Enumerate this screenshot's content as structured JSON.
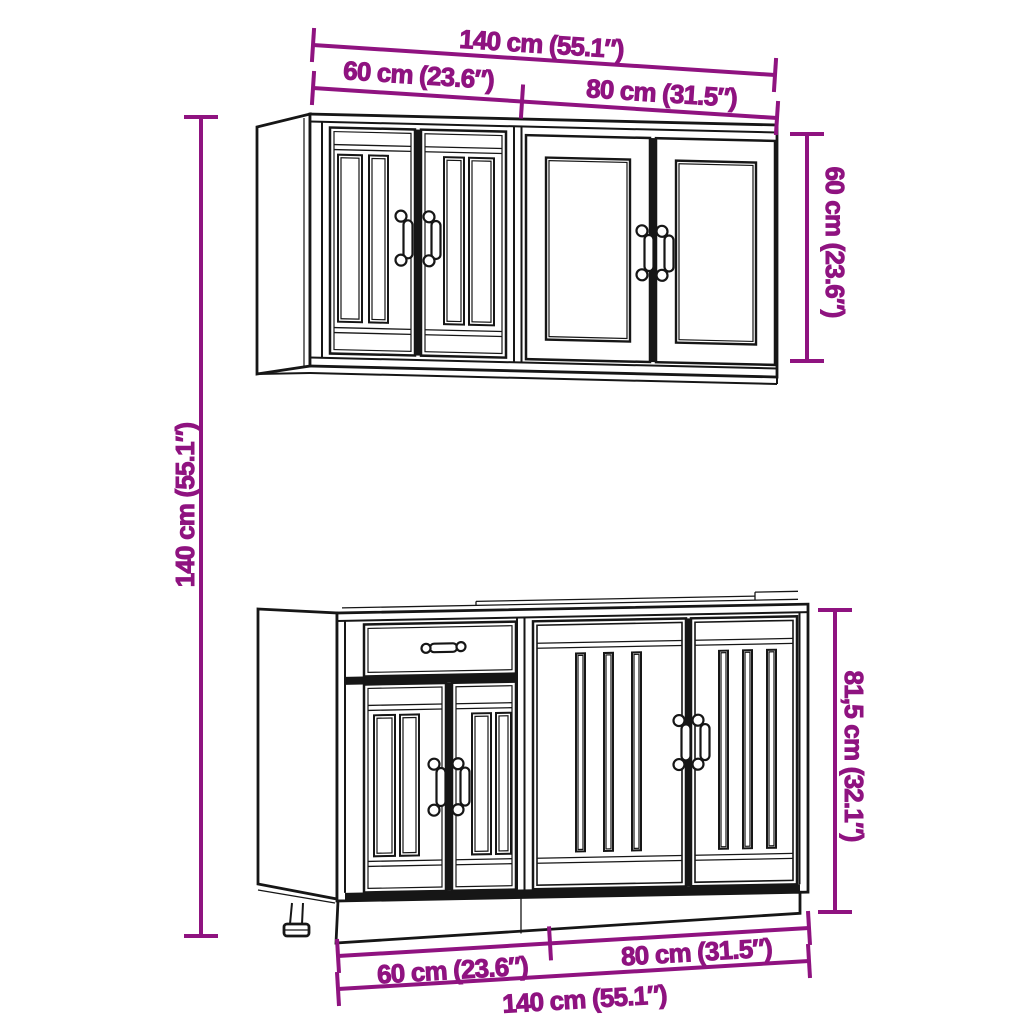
{
  "colors": {
    "dimension": "#8F1380",
    "line_art": "#161616",
    "background": "#ffffff"
  },
  "dimensions": {
    "top_total": "140 cm (55.1″)",
    "top_left_unit": "60 cm (23.6″)",
    "top_right_unit": "80 cm (31.5″)",
    "wall_cabinet_height": "60 cm (23.6″)",
    "set_total_height": "140 cm (55.1″)",
    "base_cabinet_height": "81,5 cm (32.1″)",
    "bottom_left_unit": "60 cm (23.6″)",
    "bottom_right_unit": "80 cm (31.5″)",
    "bottom_total": "140 cm (55.1″)"
  }
}
